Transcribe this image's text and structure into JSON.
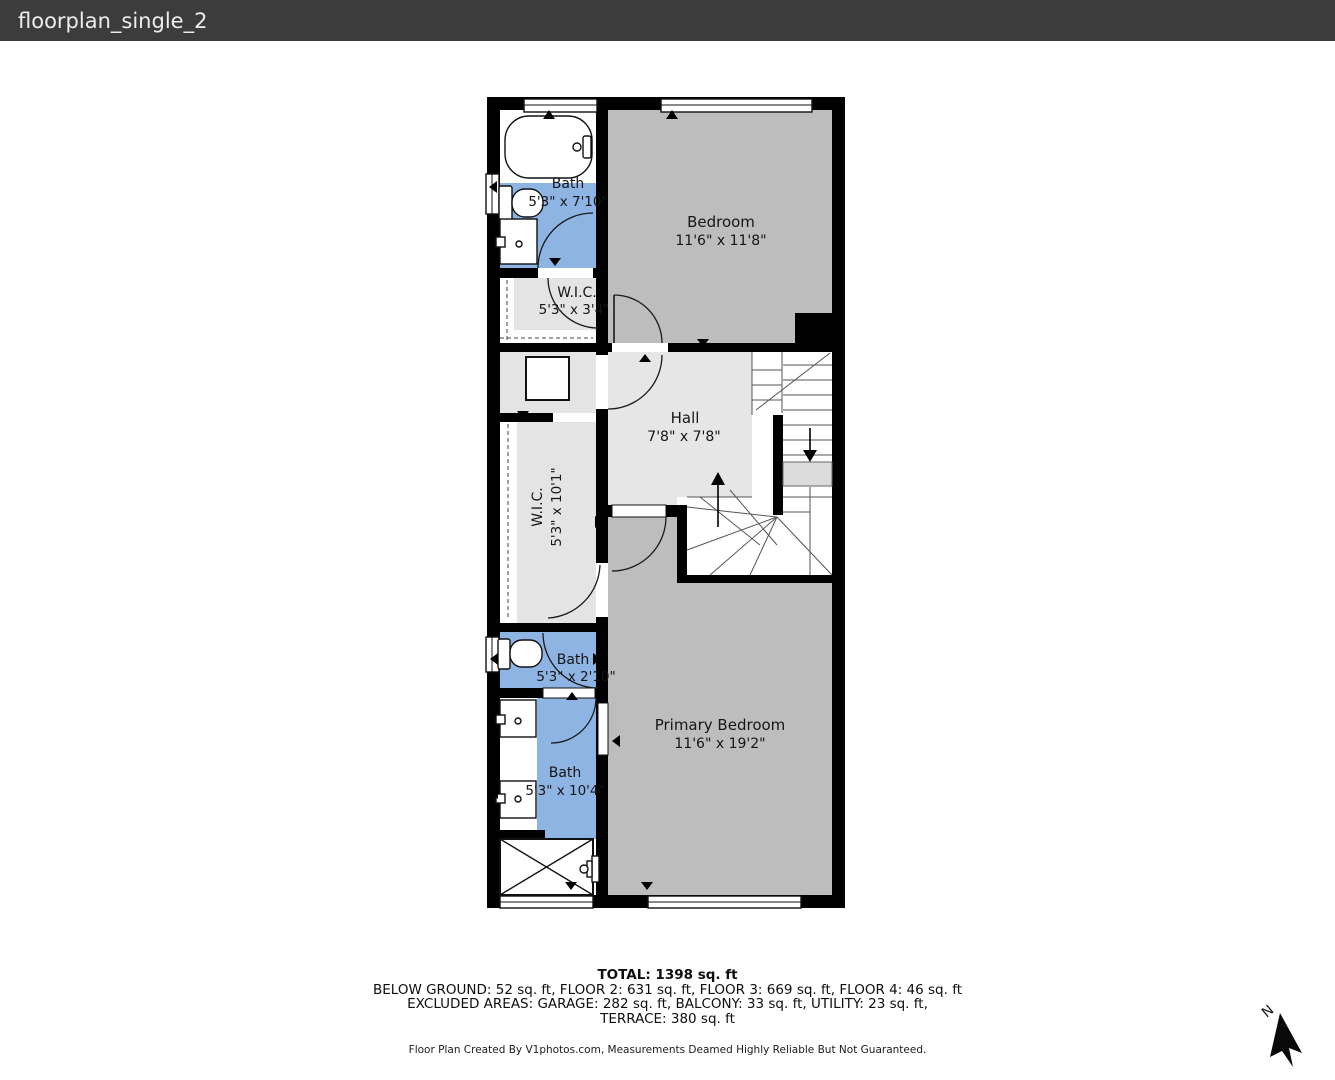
{
  "title_bar": {
    "title": "floorplan_single_2"
  },
  "floorplan": {
    "rooms": [
      {
        "id": "bath-top",
        "name": "Bath",
        "dims": "5'3\" x 7'10\""
      },
      {
        "id": "bedroom",
        "name": "Bedroom",
        "dims": "11'6\" x 11'8\""
      },
      {
        "id": "wic-top",
        "name": "W.I.C.",
        "dims": "5'3\" x 3'4\""
      },
      {
        "id": "hall",
        "name": "Hall",
        "dims": "7'8\" x 7'8\""
      },
      {
        "id": "wic-main",
        "name": "W.I.C.",
        "dims": "5'3\" x 10'1\""
      },
      {
        "id": "bath-middle",
        "name": "Bath",
        "dims": "5'3\" x 2'10\""
      },
      {
        "id": "bath-primary",
        "name": "Bath",
        "dims": "5'3\" x 10'4\""
      },
      {
        "id": "primary-bedroom",
        "name": "Primary Bedroom",
        "dims": "11'6\" x 19'2\""
      }
    ],
    "north_label": "N",
    "colors": {
      "bath_floor": "#8db4e2",
      "bedroom_floor": "#bdbdbd",
      "hall_floor": "#e6e6e6",
      "wall": "#000000",
      "title_bar": "#3c3c3c"
    }
  },
  "summary": {
    "total": "TOTAL: 1398 sq. ft",
    "floors": "BELOW GROUND: 52 sq. ft, FLOOR 2: 631 sq. ft, FLOOR 3: 669 sq. ft, FLOOR 4: 46 sq. ft",
    "excluded": "EXCLUDED AREAS: GARAGE: 282 sq. ft, BALCONY: 33 sq. ft, UTILITY: 23 sq. ft,",
    "excluded2": "TERRACE: 380 sq. ft"
  },
  "footer": {
    "credit": "Floor Plan Created By V1photos.com, Measurements Deamed Highly Reliable But Not Guaranteed."
  }
}
